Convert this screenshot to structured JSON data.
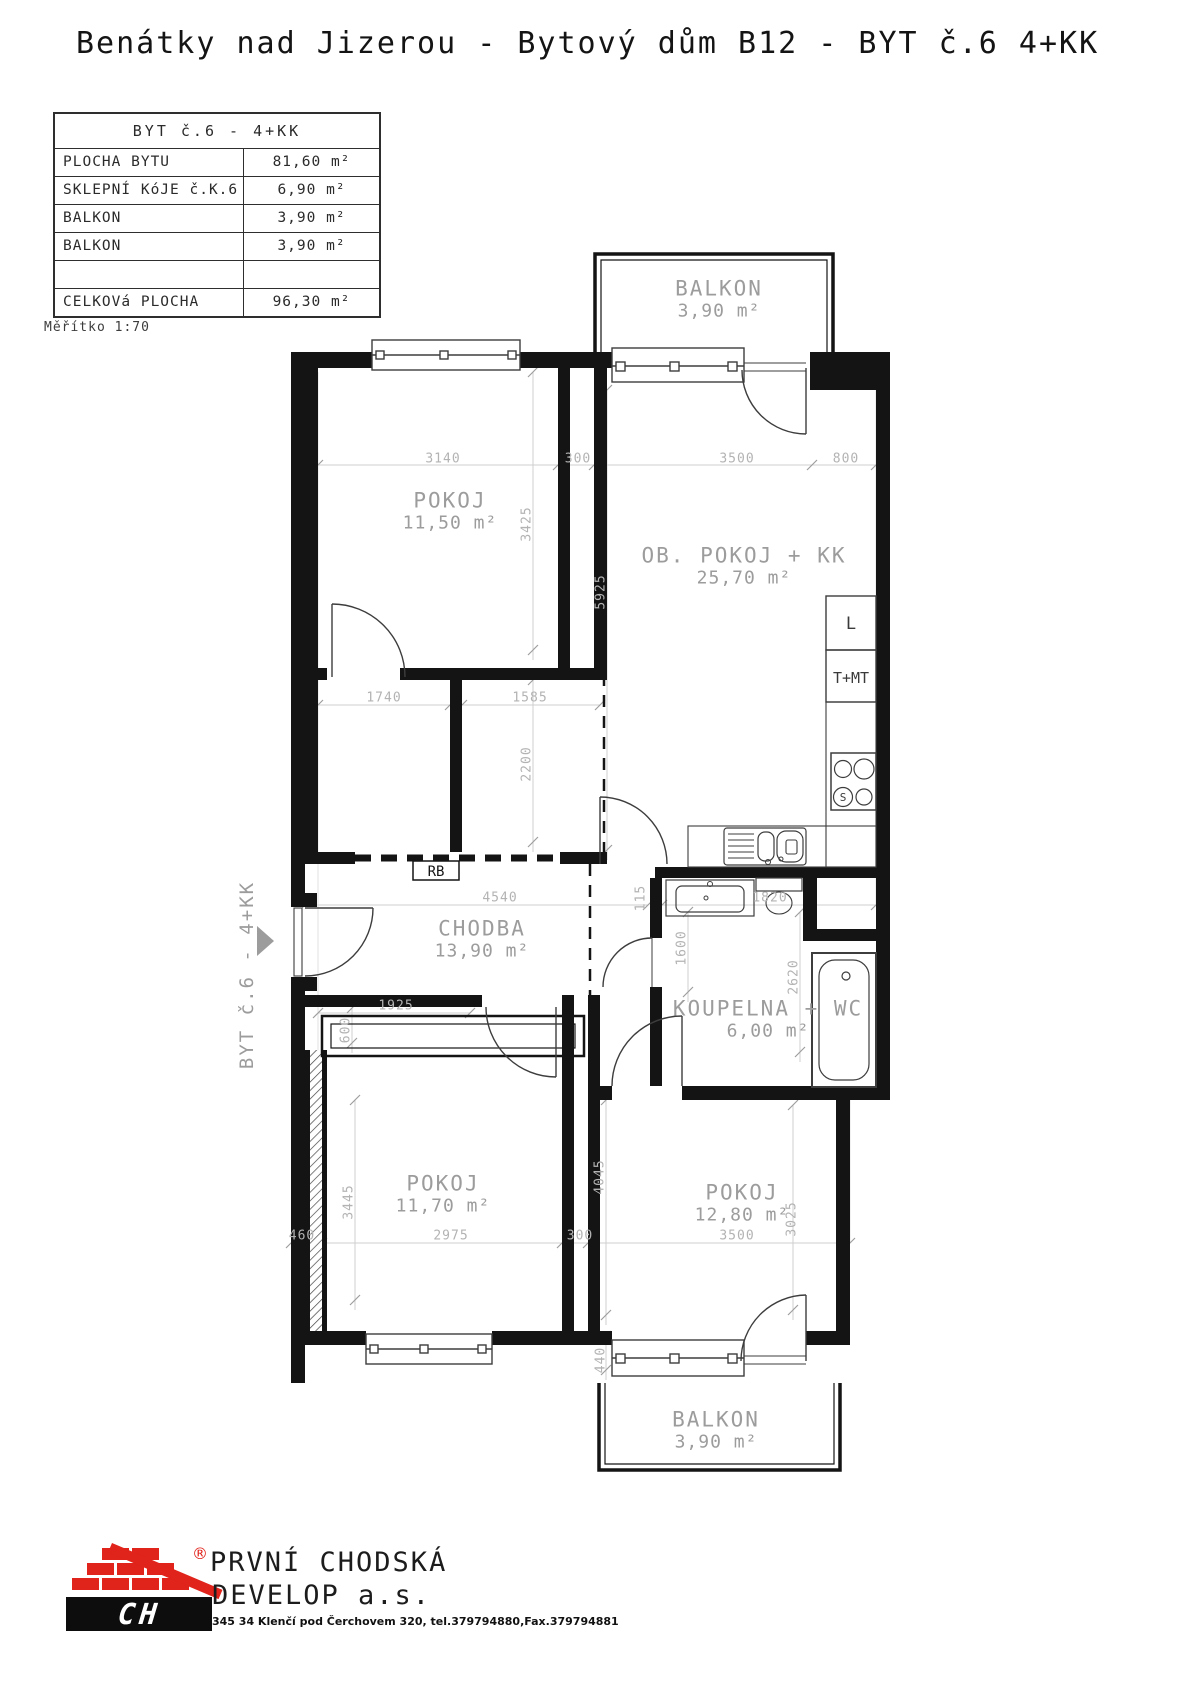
{
  "title": "Benátky nad Jizerou - Bytový dům B12 - BYT č.6 4+KK",
  "legend_table": {
    "header": "BYT č.6 - 4+KK",
    "rows": [
      {
        "label": "PLOCHA BYTU",
        "value": "81,60 m²"
      },
      {
        "label": "SKLEPNÍ KóJE č.K.6",
        "value": "6,90 m²"
      },
      {
        "label": "BALKON",
        "value": "3,90 m²"
      },
      {
        "label": "BALKON",
        "value": "3,90 m²"
      },
      {
        "label": "",
        "value": ""
      },
      {
        "label": "CELKOVá PLOCHA",
        "value": "96,30 m²"
      }
    ]
  },
  "scale_note": "Měřítko 1:70",
  "entrance_label": "BYT č.6 - 4+KK",
  "rooms": [
    {
      "name": "POKOJ",
      "area": "11,50 m²",
      "x": 450,
      "y": 511
    },
    {
      "name": "OB. POKOJ + KK",
      "area": "25,70 m²",
      "x": 744,
      "y": 566
    },
    {
      "name": "CHODBA",
      "area": "13,90 m²",
      "x": 482,
      "y": 939
    },
    {
      "name": "KOUPELNA + WC",
      "area": "6,00 m²",
      "x": 768,
      "y": 1019
    },
    {
      "name": "POKOJ",
      "area": "11,70 m²",
      "x": 443,
      "y": 1194
    },
    {
      "name": "POKOJ",
      "area": "12,80 m²",
      "x": 742,
      "y": 1203
    },
    {
      "name": "BALKON",
      "area": "3,90 m²",
      "x": 719,
      "y": 299
    },
    {
      "name": "BALKON",
      "area": "3,90 m²",
      "x": 716,
      "y": 1430
    }
  ],
  "dimensions": [
    {
      "v": "3140",
      "x": 443,
      "y": 459,
      "r": 0
    },
    {
      "v": "300",
      "x": 578,
      "y": 459,
      "r": 0
    },
    {
      "v": "3500",
      "x": 737,
      "y": 459,
      "r": 0
    },
    {
      "v": "800",
      "x": 846,
      "y": 459,
      "r": 0
    },
    {
      "v": "3425",
      "x": 527,
      "y": 524,
      "r": -90
    },
    {
      "v": "5925",
      "x": 601,
      "y": 592,
      "r": -90
    },
    {
      "v": "1740",
      "x": 384,
      "y": 698,
      "r": 0
    },
    {
      "v": "1585",
      "x": 530,
      "y": 698,
      "r": 0
    },
    {
      "v": "2200",
      "x": 527,
      "y": 764,
      "r": -90
    },
    {
      "v": "4540",
      "x": 500,
      "y": 898,
      "r": 0
    },
    {
      "v": "115",
      "x": 641,
      "y": 898,
      "r": -90
    },
    {
      "v": "1820",
      "x": 770,
      "y": 898,
      "r": 0
    },
    {
      "v": "1600",
      "x": 682,
      "y": 948,
      "r": -90
    },
    {
      "v": "2620",
      "x": 794,
      "y": 977,
      "r": -90
    },
    {
      "v": "1925",
      "x": 396,
      "y": 1006,
      "r": 0
    },
    {
      "v": "600",
      "x": 346,
      "y": 1030,
      "r": -90
    },
    {
      "v": "3445",
      "x": 349,
      "y": 1202,
      "r": -90
    },
    {
      "v": "460",
      "x": 302,
      "y": 1236,
      "r": 0
    },
    {
      "v": "2975",
      "x": 451,
      "y": 1236,
      "r": 0
    },
    {
      "v": "300",
      "x": 580,
      "y": 1236,
      "r": 0
    },
    {
      "v": "3500",
      "x": 737,
      "y": 1236,
      "r": 0
    },
    {
      "v": "4045",
      "x": 600,
      "y": 1177,
      "r": -90
    },
    {
      "v": "3025",
      "x": 792,
      "y": 1219,
      "r": -90
    },
    {
      "v": "440",
      "x": 601,
      "y": 1360,
      "r": -90
    }
  ],
  "fixtures": {
    "fridge": "L",
    "boiler": "T+MT",
    "switchboard": "RB",
    "stove_mark": "S"
  },
  "logo": {
    "company_line1": "PRVNÍ CHODSKÁ",
    "company_line2": "DEVELOP a.s.",
    "monogram": "CH",
    "registered": "®",
    "address": "345 34 Klenčí pod Čerchovem 320,  tel.379794880,Fax.379794881",
    "brand_red": "#e0231b"
  }
}
